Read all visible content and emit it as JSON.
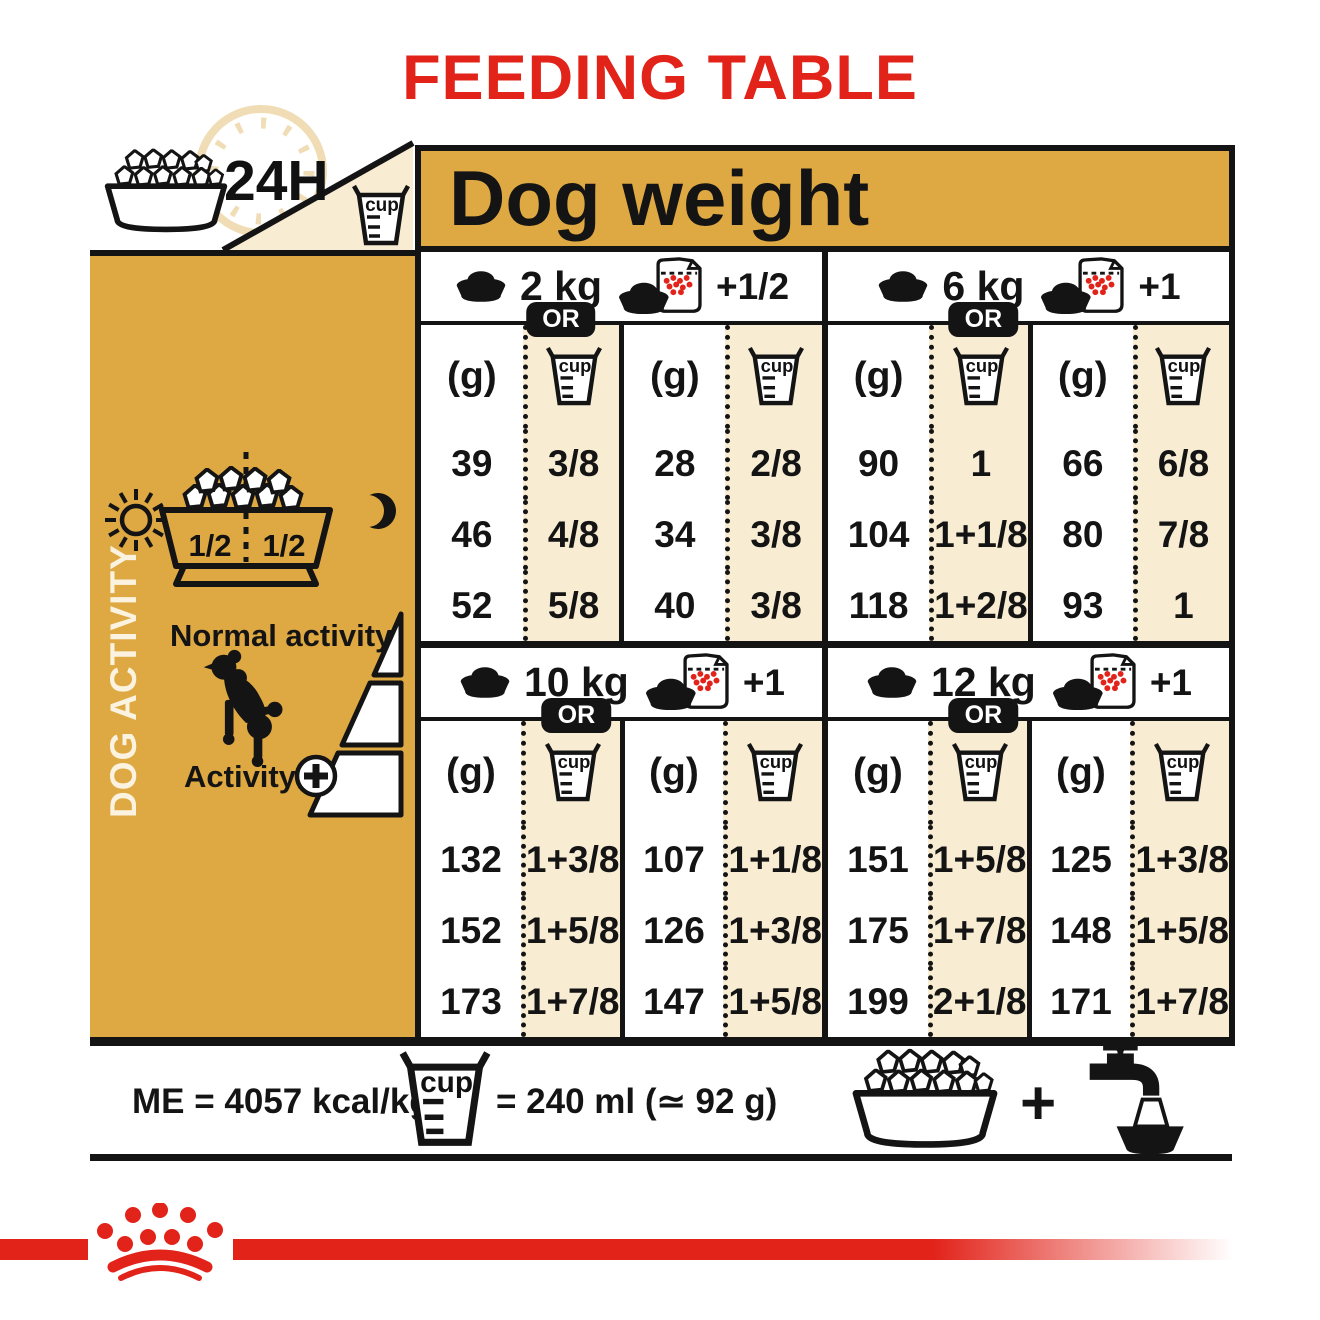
{
  "title": "FEEDING TABLE",
  "colors": {
    "brand_red": "#e2231a",
    "gold": "#dea843",
    "cream": "#f8edd3",
    "ink": "#141414"
  },
  "top": {
    "hours_label": "24H",
    "dog_weight_label": "Dog weight"
  },
  "labels": {
    "g": "(g)",
    "cup": "cup",
    "or": "OR"
  },
  "sidebar": {
    "vertical_label": "DOG ACTIVITY",
    "bowl_half_left": "1/2",
    "bowl_half_right": "1/2",
    "normal_activity_label": "Normal activity",
    "activity_label": "Activity"
  },
  "tables": [
    {
      "weight": "2 kg",
      "extra": "+1/2",
      "dry_g": [
        "39",
        "46",
        "52"
      ],
      "dry_cup": [
        "3/8",
        "4/8",
        "5/8"
      ],
      "mix_g": [
        "28",
        "34",
        "40"
      ],
      "mix_cup": [
        "2/8",
        "3/8",
        "3/8"
      ]
    },
    {
      "weight": "6 kg",
      "extra": "+1",
      "dry_g": [
        "90",
        "104",
        "118"
      ],
      "dry_cup": [
        "1",
        "1+1/8",
        "1+2/8"
      ],
      "mix_g": [
        "66",
        "80",
        "93"
      ],
      "mix_cup": [
        "6/8",
        "7/8",
        "1"
      ]
    },
    {
      "weight": "10 kg",
      "extra": "+1",
      "dry_g": [
        "132",
        "152",
        "173"
      ],
      "dry_cup": [
        "1+3/8",
        "1+5/8",
        "1+7/8"
      ],
      "mix_g": [
        "107",
        "126",
        "147"
      ],
      "mix_cup": [
        "1+1/8",
        "1+3/8",
        "1+5/8"
      ]
    },
    {
      "weight": "12 kg",
      "extra": "+1",
      "dry_g": [
        "151",
        "175",
        "199"
      ],
      "dry_cup": [
        "1+5/8",
        "1+7/8",
        "2+1/8"
      ],
      "mix_g": [
        "125",
        "148",
        "171"
      ],
      "mix_cup": [
        "1+3/8",
        "1+5/8",
        "1+7/8"
      ]
    }
  ],
  "footer": {
    "me_label": "ME = 4057 kcal/kg",
    "cup_equals_label": "= 240 ml (≃ 92 g)",
    "plus": "+"
  }
}
